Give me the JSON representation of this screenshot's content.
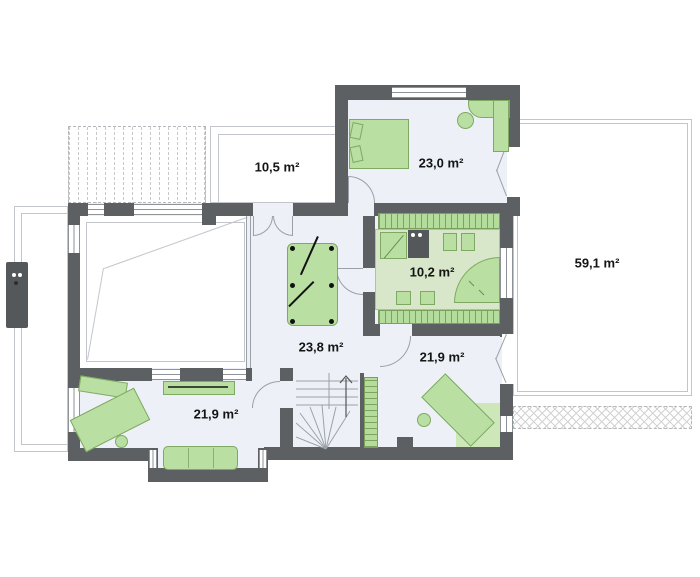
{
  "title": "House floor plan – upper storey",
  "rooms": [
    {
      "id": "balcony",
      "area": "10,5 m²"
    },
    {
      "id": "bedroom-top",
      "area": "23,0 m²"
    },
    {
      "id": "terrace",
      "area": "59,1 m²"
    },
    {
      "id": "bathroom",
      "area": "10,2 m²"
    },
    {
      "id": "hall",
      "area": "23,8 m²"
    },
    {
      "id": "bedroom-bottom-left",
      "area": "21,9 m²"
    },
    {
      "id": "bedroom-bottom-right",
      "area": "21,9 m²"
    }
  ],
  "colors": {
    "wall": "#5c6063",
    "floor": "#edf1f7",
    "furniture_fill": "#b9dfa2",
    "furniture_border": "#7fa863",
    "bathroom_floor": "#d8e7c9",
    "outline": "#c2c6cb",
    "label_text": "#141414"
  }
}
